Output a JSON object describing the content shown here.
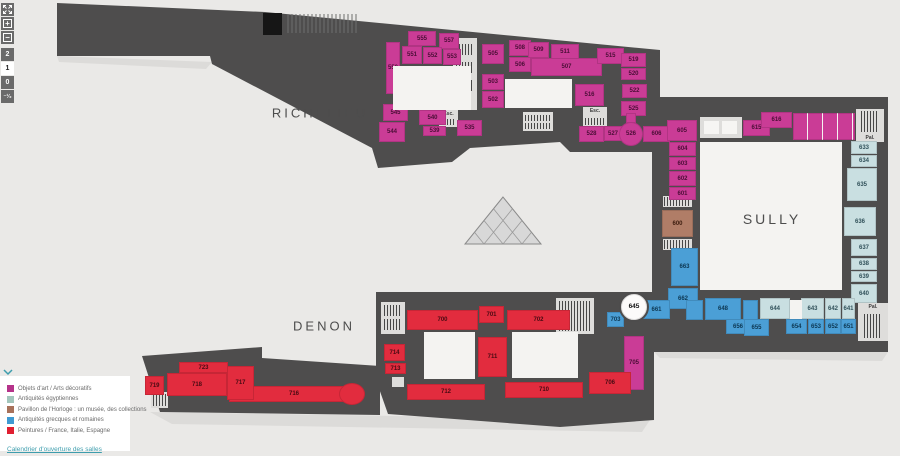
{
  "controls": {
    "zoom_in": "+",
    "zoom_out": "−",
    "floors": [
      {
        "label": "2",
        "active": false
      },
      {
        "label": "1",
        "active": true
      },
      {
        "label": "0",
        "active": false
      },
      {
        "label": "⁻¹⁄₂",
        "active": false
      }
    ]
  },
  "wings": {
    "richelieu": "RICHELIEU",
    "sully": "SULLY",
    "denon": "DENON"
  },
  "legend": {
    "items": [
      {
        "color": "#b5338a",
        "label": "Objets d'art / Arts décoratifs"
      },
      {
        "color": "#a3c6bc",
        "label": "Antiquités égyptiennes"
      },
      {
        "color": "#a8715a",
        "label": "Pavillon de l'Horloge : un musée, des collections"
      },
      {
        "color": "#3f9ad2",
        "label": "Antiquités grecques et romaines"
      },
      {
        "color": "#e01f31",
        "label": "Peintures / France, Italie, Espagne"
      }
    ],
    "link": "Calendrier d'ouverture des salles"
  },
  "colors": {
    "building": "#4e4d4d",
    "background": "#eae9e7",
    "magenta": "#ca3c96",
    "egyptian": "#c9dfe1",
    "horloge": "#b07d67",
    "greek": "#4b9fd6",
    "red": "#e22c3e"
  },
  "rooms": [
    {
      "n": "550",
      "r": [
        386,
        42,
        14,
        52
      ],
      "c": "m"
    },
    {
      "n": "555",
      "r": [
        408,
        31,
        28,
        15
      ],
      "c": "m"
    },
    {
      "n": "557",
      "r": [
        439,
        33,
        20,
        16
      ],
      "c": "m"
    },
    {
      "n": "551",
      "r": [
        402,
        46,
        20,
        18
      ],
      "c": "m"
    },
    {
      "n": "552",
      "r": [
        423,
        47,
        19,
        17
      ],
      "c": "m"
    },
    {
      "n": "553",
      "r": [
        443,
        49,
        18,
        16
      ],
      "c": "m"
    },
    {
      "n": "505",
      "r": [
        482,
        44,
        22,
        20
      ],
      "c": "m"
    },
    {
      "n": "508",
      "r": [
        509,
        40,
        22,
        16
      ],
      "c": "m"
    },
    {
      "n": "509",
      "r": [
        528,
        42,
        21,
        16
      ],
      "c": "m"
    },
    {
      "n": "511",
      "r": [
        551,
        44,
        28,
        16
      ],
      "c": "m"
    },
    {
      "n": "506",
      "r": [
        509,
        57,
        22,
        15
      ],
      "c": "m"
    },
    {
      "n": "507",
      "r": [
        531,
        58,
        71,
        18
      ],
      "c": "m"
    },
    {
      "n": "515",
      "r": [
        597,
        48,
        27,
        16
      ],
      "c": "m"
    },
    {
      "n": "519",
      "r": [
        621,
        53,
        25,
        14
      ],
      "c": "m"
    },
    {
      "n": "520",
      "r": [
        621,
        68,
        25,
        12
      ],
      "c": "m"
    },
    {
      "n": "522",
      "r": [
        622,
        84,
        25,
        14
      ],
      "c": "m"
    },
    {
      "n": "525",
      "r": [
        621,
        101,
        25,
        15
      ],
      "c": "m"
    },
    {
      "n": "503",
      "r": [
        482,
        74,
        22,
        16
      ],
      "c": "m"
    },
    {
      "n": "502",
      "r": [
        482,
        91,
        22,
        17
      ],
      "c": "m"
    },
    {
      "n": "516",
      "r": [
        575,
        84,
        29,
        22
      ],
      "c": "m"
    },
    {
      "n": "545",
      "r": [
        383,
        104,
        25,
        17
      ],
      "c": "m"
    },
    {
      "n": "544",
      "r": [
        379,
        122,
        26,
        20
      ],
      "c": "m"
    },
    {
      "n": "540",
      "r": [
        419,
        110,
        27,
        15
      ],
      "c": "m"
    },
    {
      "n": "539",
      "r": [
        423,
        126,
        23,
        10
      ],
      "c": "m"
    },
    {
      "n": "535",
      "r": [
        457,
        120,
        25,
        16
      ],
      "c": "m"
    },
    {
      "n": "528",
      "r": [
        579,
        126,
        25,
        16
      ],
      "c": "m"
    },
    {
      "n": "527",
      "r": [
        604,
        126,
        18,
        15
      ],
      "c": "m"
    },
    {
      "n": "606",
      "r": [
        643,
        126,
        27,
        16
      ],
      "c": "m"
    },
    {
      "n": "605",
      "r": [
        667,
        120,
        30,
        21
      ],
      "c": "m"
    },
    {
      "n": "604",
      "r": [
        669,
        142,
        27,
        14
      ],
      "c": "m"
    },
    {
      "n": "603",
      "r": [
        669,
        157,
        27,
        13
      ],
      "c": "m"
    },
    {
      "n": "602",
      "r": [
        669,
        171,
        27,
        15
      ],
      "c": "m"
    },
    {
      "n": "601",
      "r": [
        669,
        187,
        27,
        13
      ],
      "c": "m"
    },
    {
      "n": "615",
      "r": [
        743,
        120,
        27,
        16
      ],
      "c": "m"
    },
    {
      "n": "616",
      "r": [
        761,
        112,
        31,
        16
      ],
      "c": "m"
    },
    {
      "n": "705",
      "r": [
        624,
        336,
        20,
        54
      ],
      "c": "m"
    },
    {
      "r": [
        793,
        113,
        62,
        27
      ],
      "c": "m",
      "t": 1
    },
    {
      "r": [
        626,
        113,
        10,
        10
      ],
      "c": "m"
    },
    {
      "n": "526",
      "r": [
        619,
        122,
        24,
        24
      ],
      "c": "m",
      "shape": "circle"
    },
    {
      "n": "600",
      "r": [
        662,
        210,
        31,
        27
      ],
      "c": "b"
    },
    {
      "n": "633",
      "r": [
        851,
        141,
        26,
        13
      ],
      "c": "e"
    },
    {
      "n": "634",
      "r": [
        851,
        155,
        26,
        12
      ],
      "c": "e"
    },
    {
      "n": "635",
      "r": [
        847,
        168,
        30,
        33
      ],
      "c": "e"
    },
    {
      "n": "636",
      "r": [
        844,
        207,
        32,
        29
      ],
      "c": "e"
    },
    {
      "n": "637",
      "r": [
        851,
        239,
        26,
        17
      ],
      "c": "e"
    },
    {
      "n": "638",
      "r": [
        851,
        258,
        26,
        12
      ],
      "c": "e"
    },
    {
      "n": "639",
      "r": [
        851,
        271,
        26,
        11
      ],
      "c": "e"
    },
    {
      "n": "640",
      "r": [
        851,
        284,
        26,
        19
      ],
      "c": "e"
    },
    {
      "n": "644",
      "r": [
        760,
        298,
        30,
        21
      ],
      "c": "e"
    },
    {
      "n": "643",
      "r": [
        801,
        298,
        23,
        21
      ],
      "c": "e"
    },
    {
      "n": "642",
      "r": [
        825,
        298,
        16,
        21
      ],
      "c": "e"
    },
    {
      "n": "641",
      "r": [
        842,
        298,
        13,
        21
      ],
      "c": "e"
    },
    {
      "n": "663",
      "r": [
        671,
        248,
        27,
        38
      ],
      "c": "g"
    },
    {
      "n": "662",
      "r": [
        668,
        288,
        30,
        21
      ],
      "c": "g"
    },
    {
      "n": "661",
      "r": [
        643,
        300,
        27,
        19
      ],
      "c": "g"
    },
    {
      "n": "648",
      "r": [
        705,
        298,
        36,
        22
      ],
      "c": "g"
    },
    {
      "r": [
        686,
        300,
        17,
        20
      ],
      "c": "g"
    },
    {
      "r": [
        743,
        300,
        15,
        20
      ],
      "c": "g"
    },
    {
      "n": "656",
      "r": [
        726,
        319,
        24,
        15
      ],
      "c": "g"
    },
    {
      "n": "655",
      "r": [
        744,
        319,
        25,
        17
      ],
      "c": "g"
    },
    {
      "n": "654",
      "r": [
        786,
        319,
        21,
        15
      ],
      "c": "g"
    },
    {
      "n": "653",
      "r": [
        808,
        319,
        16,
        15
      ],
      "c": "g"
    },
    {
      "n": "652",
      "r": [
        825,
        319,
        16,
        15
      ],
      "c": "g"
    },
    {
      "n": "651",
      "r": [
        841,
        319,
        15,
        15
      ],
      "c": "g"
    },
    {
      "n": "703",
      "r": [
        607,
        312,
        17,
        15
      ],
      "c": "g"
    },
    {
      "n": "700",
      "r": [
        407,
        310,
        71,
        20
      ],
      "c": "r"
    },
    {
      "n": "701",
      "r": [
        479,
        306,
        25,
        17
      ],
      "c": "r"
    },
    {
      "n": "702",
      "r": [
        507,
        310,
        63,
        20
      ],
      "c": "r"
    },
    {
      "n": "706",
      "r": [
        589,
        372,
        42,
        22
      ],
      "c": "r"
    },
    {
      "n": "714",
      "r": [
        384,
        344,
        21,
        17
      ],
      "c": "r"
    },
    {
      "n": "713",
      "r": [
        385,
        363,
        21,
        11
      ],
      "c": "r"
    },
    {
      "n": "711",
      "r": [
        478,
        337,
        29,
        40
      ],
      "c": "r"
    },
    {
      "n": "710",
      "r": [
        505,
        382,
        78,
        16
      ],
      "c": "r"
    },
    {
      "n": "712",
      "r": [
        407,
        384,
        78,
        16
      ],
      "c": "r"
    },
    {
      "n": "716",
      "r": [
        229,
        386,
        130,
        16
      ],
      "c": "r"
    },
    {
      "n": "717",
      "r": [
        227,
        366,
        27,
        34
      ],
      "c": "r"
    },
    {
      "n": "718",
      "r": [
        167,
        373,
        60,
        23
      ],
      "c": "r"
    },
    {
      "n": "723",
      "r": [
        179,
        362,
        49,
        11
      ],
      "c": "r"
    },
    {
      "n": "719",
      "r": [
        145,
        376,
        19,
        19
      ],
      "c": "r"
    },
    {
      "r": [
        558,
        334,
        14,
        38
      ],
      "c": "r"
    },
    {
      "r": [
        339,
        383,
        26,
        22
      ],
      "c": "r",
      "shape": "circle"
    },
    {
      "r": [
        393,
        66,
        78,
        44
      ],
      "c": "w"
    },
    {
      "r": [
        505,
        79,
        67,
        29
      ],
      "c": "w"
    },
    {
      "r": [
        700,
        142,
        142,
        148
      ],
      "c": "w"
    },
    {
      "r": [
        424,
        332,
        51,
        47
      ],
      "c": "w"
    },
    {
      "r": [
        512,
        332,
        66,
        46
      ],
      "c": "w"
    },
    {
      "r": [
        790,
        300,
        12,
        19
      ],
      "c": "w"
    },
    {
      "n": "645",
      "r": [
        619,
        292,
        30,
        30
      ],
      "c": "w645",
      "shape": "circle"
    }
  ],
  "stairs": [
    {
      "r": [
        453,
        38,
        24,
        72
      ],
      "bars": [
        [
          3,
          6,
          18,
          11
        ],
        [
          3,
          24,
          18,
          11
        ],
        [
          3,
          42,
          18,
          11
        ]
      ]
    },
    {
      "r": [
        523,
        112,
        30,
        19
      ],
      "bars": [
        [
          2,
          3,
          26,
          6
        ],
        [
          2,
          11,
          26,
          6
        ]
      ]
    },
    {
      "r": [
        583,
        107,
        24,
        20
      ],
      "label": "Esc.",
      "lp": "t",
      "bars": [
        [
          2,
          11,
          20,
          7
        ]
      ]
    },
    {
      "r": [
        439,
        110,
        19,
        17
      ],
      "label": "Esc.",
      "lp": "t",
      "bars": [
        [
          2,
          9,
          15,
          6
        ]
      ]
    },
    {
      "r": [
        663,
        196,
        29,
        11
      ],
      "bars": [
        [
          1,
          1,
          27,
          9
        ]
      ]
    },
    {
      "r": [
        663,
        239,
        29,
        11
      ],
      "bars": [
        [
          1,
          1,
          27,
          9
        ]
      ]
    },
    {
      "r": [
        856,
        109,
        28,
        33
      ],
      "label": "Pal.",
      "lp": "b",
      "bars": [
        [
          5,
          2,
          18,
          21
        ]
      ]
    },
    {
      "r": [
        858,
        303,
        30,
        38
      ],
      "label": "Pal.",
      "lp": "t",
      "bars": [
        [
          6,
          11,
          18,
          24
        ]
      ]
    },
    {
      "r": [
        381,
        302,
        24,
        32
      ],
      "bars": [
        [
          3,
          3,
          18,
          11
        ],
        [
          3,
          17,
          18,
          11
        ]
      ]
    },
    {
      "r": [
        556,
        298,
        38,
        36
      ],
      "bars": [
        [
          3,
          3,
          7,
          30
        ],
        [
          12,
          3,
          7,
          30
        ],
        [
          21,
          3,
          7,
          30
        ],
        [
          30,
          3,
          6,
          30
        ]
      ]
    },
    {
      "r": [
        151,
        392,
        17,
        16
      ],
      "bars": [
        [
          2,
          2,
          13,
          12
        ]
      ]
    },
    {
      "r": [
        700,
        117,
        42,
        21
      ],
      "boxes": [
        [
          4,
          4,
          15,
          13
        ],
        [
          22,
          4,
          15,
          13
        ]
      ]
    },
    {
      "r": [
        392,
        377,
        12,
        10
      ]
    },
    {
      "r": [
        230,
        370,
        12,
        10
      ]
    },
    {
      "r": [
        230,
        382,
        12,
        10
      ]
    }
  ]
}
